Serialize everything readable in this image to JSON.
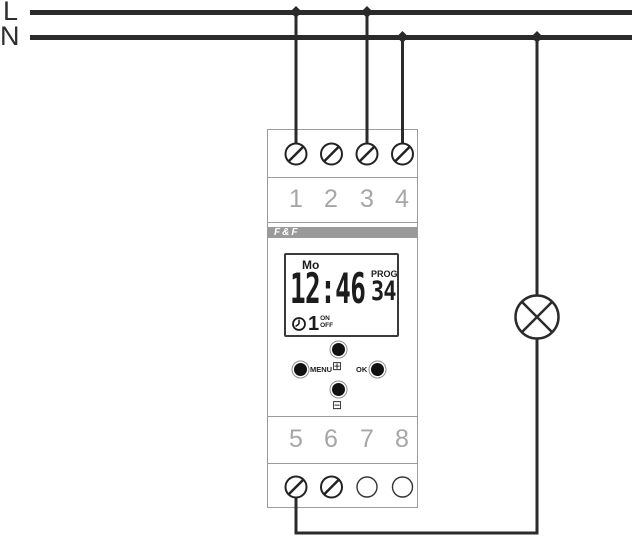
{
  "power": {
    "line_l_label": "L",
    "line_n_label": "N"
  },
  "device": {
    "brand": "F&F",
    "top_terminals": [
      "1",
      "2",
      "3",
      "4"
    ],
    "bottom_terminals": [
      "5",
      "6",
      "7",
      "8"
    ],
    "display": {
      "day": "Mo",
      "time": "12:46",
      "prog_label": "PROG",
      "prog_number": "34",
      "channel": "1",
      "on_label": "ON",
      "off_label": "OFF"
    },
    "buttons": {
      "menu_label": "MENU",
      "ok_label": "OK",
      "plus_glyph": "⊞",
      "minus_glyph": "⊟"
    }
  },
  "colors": {
    "wire": "#2b2b2b",
    "device_outline": "#9b9b9b",
    "terminal_number": "#a6a6a6",
    "brand_band": "#9a9a9a"
  }
}
